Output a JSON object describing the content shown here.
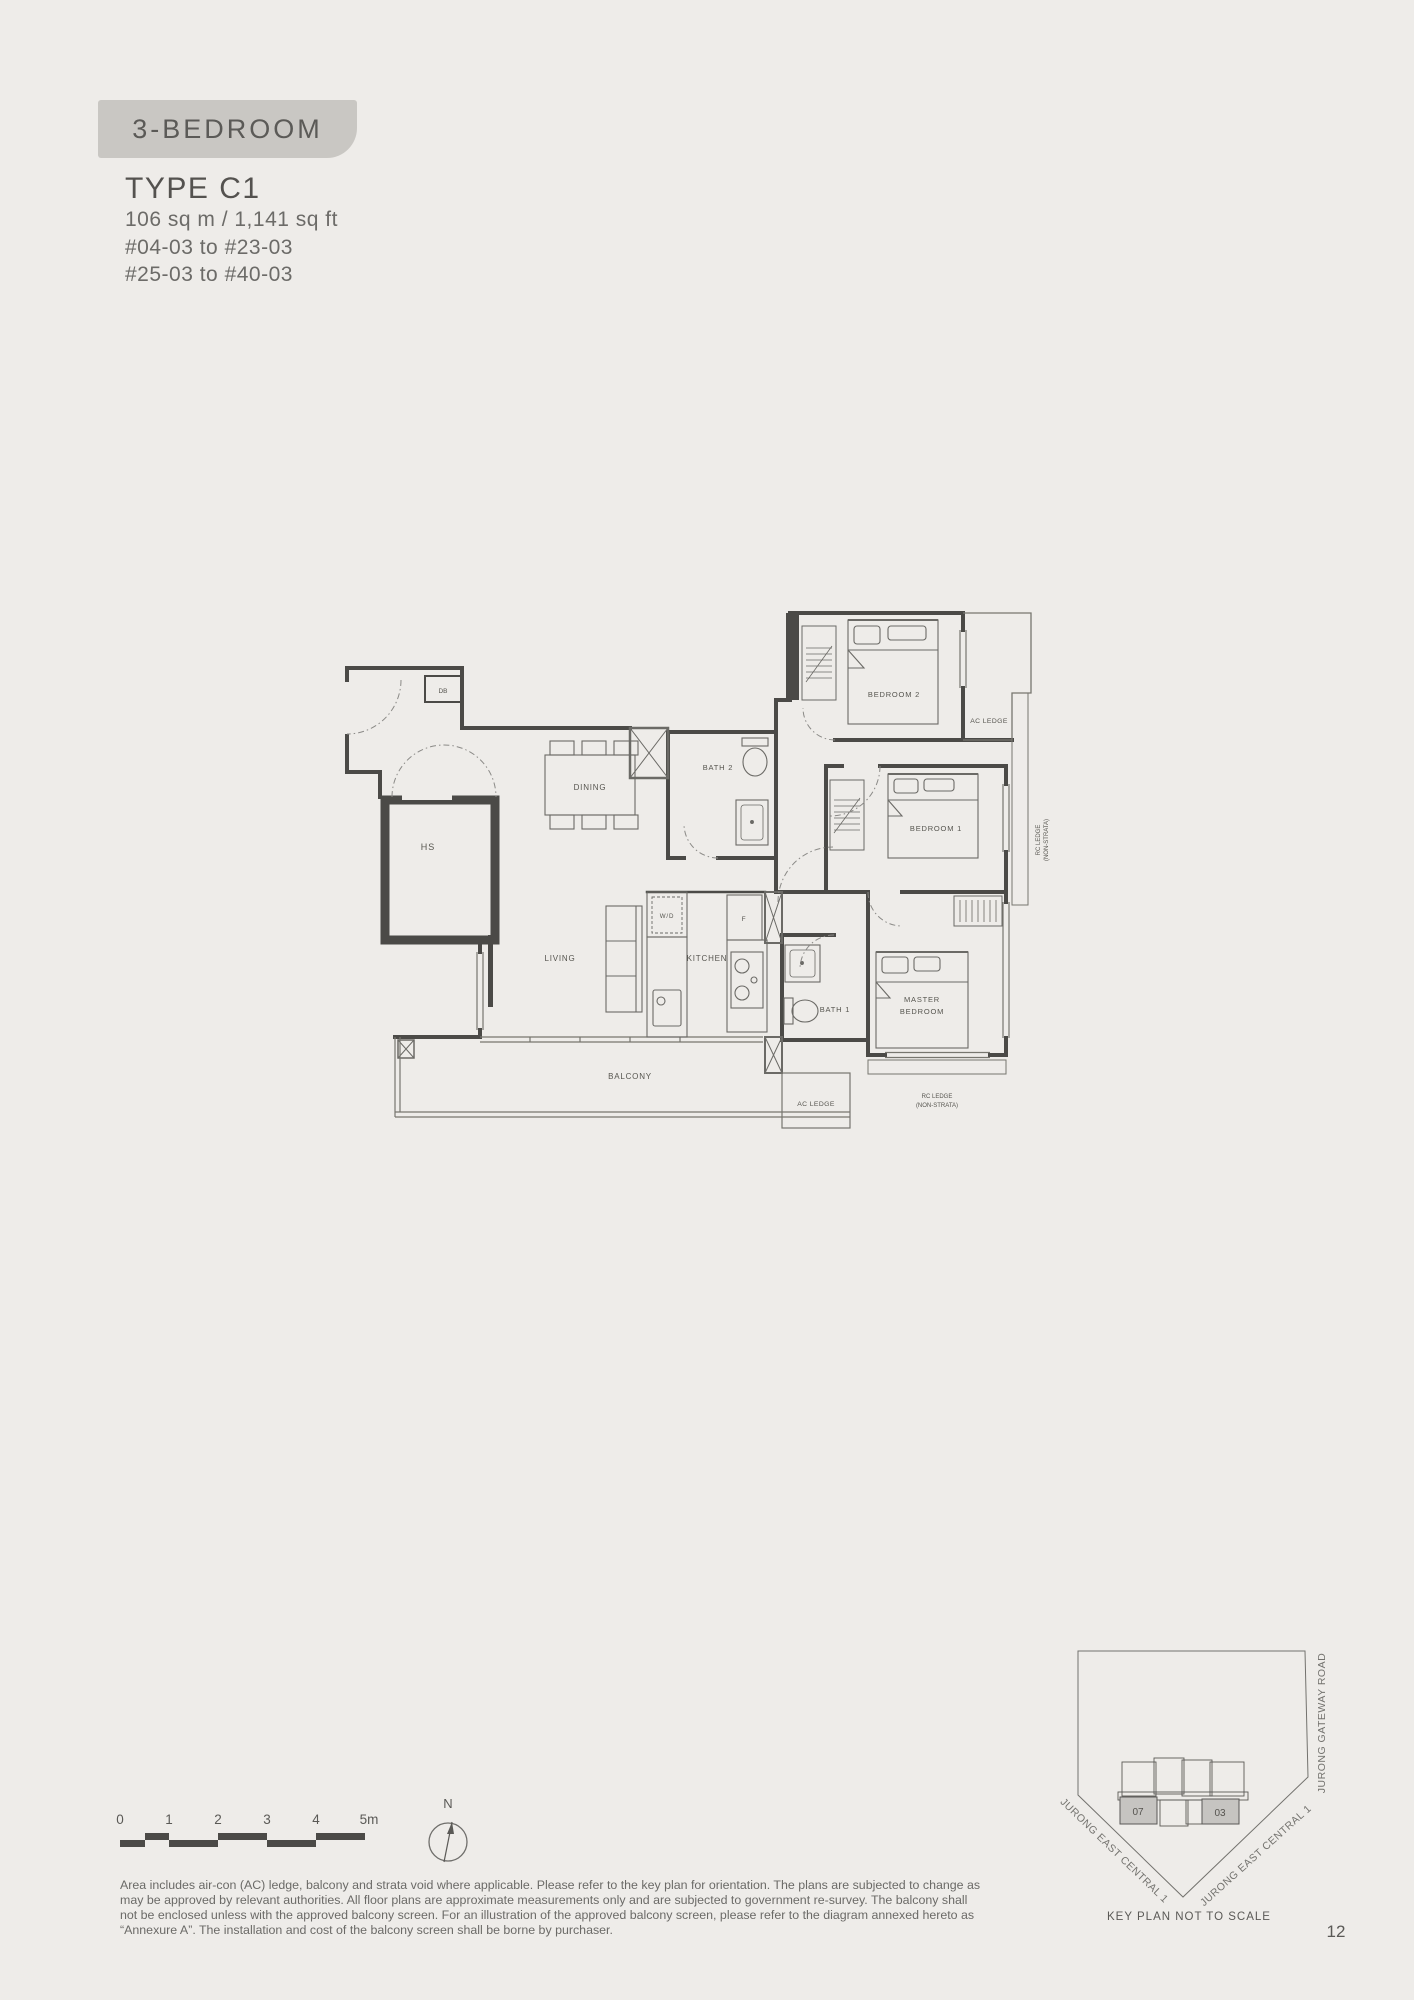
{
  "page": {
    "badge": "3-BEDROOM",
    "type_title": "TYPE C1",
    "area": "106 sq m / 1,141 sq ft",
    "units_line1": "#04-03 to #23-03",
    "units_line2": "#25-03 to #40-03",
    "page_number": "12"
  },
  "floor_plan": {
    "labels": {
      "db": "DB",
      "hs": "HS",
      "dining": "DINING",
      "bath2": "BATH 2",
      "bedroom2": "BEDROOM 2",
      "ac_ledge_top": "AC LEDGE",
      "bedroom1": "BEDROOM 1",
      "rc_ledge_right_1": "RC LEDGE",
      "rc_ledge_right_2": "(NON-STRATA)",
      "wd": "W/D",
      "fridge": "F",
      "living": "LIVING",
      "kitchen": "KITCHEN",
      "bath1": "BATH 1",
      "master_1": "MASTER",
      "master_2": "BEDROOM",
      "balcony": "BALCONY",
      "ac_ledge_bottom": "AC LEDGE",
      "rc_ledge_bottom_1": "RC LEDGE",
      "rc_ledge_bottom_2": "(NON-STRATA)"
    }
  },
  "scale_bar": {
    "ticks": [
      "0",
      "1",
      "2",
      "3",
      "4",
      "5m"
    ]
  },
  "compass": {
    "north_label": "N"
  },
  "disclaimer": {
    "lines": [
      "Area includes air-con (AC) ledge, balcony and strata void where applicable. Please refer to the key plan for orientation. The plans are subjected to change as",
      "may be approved by relevant authorities. All floor plans are approximate measurements only and are subjected to government re-survey. The balcony shall",
      "not be enclosed unless with the approved balcony screen. For an illustration of the approved balcony screen, please refer to the diagram annexed hereto as",
      "“Annexure A”. The installation and cost of the balcony screen shall be borne by purchaser."
    ]
  },
  "key_plan": {
    "roads": {
      "right": "JURONG GATEWAY ROAD",
      "left_diag": "JURONG EAST CENTRAL 1",
      "right_diag": "JURONG EAST CENTRAL 1"
    },
    "units": {
      "left": "07",
      "right": "03"
    },
    "caption": "KEY PLAN NOT TO SCALE"
  },
  "colors": {
    "page_bg": "#eeece9",
    "badge_bg": "#c9c7c3",
    "wall": "#4b4a47",
    "fixture": "#6b6a66",
    "light_line": "#77766f",
    "text_primary": "#54524f",
    "text_secondary": "#6c6b68",
    "unit_fill": "#c6c4c1"
  }
}
